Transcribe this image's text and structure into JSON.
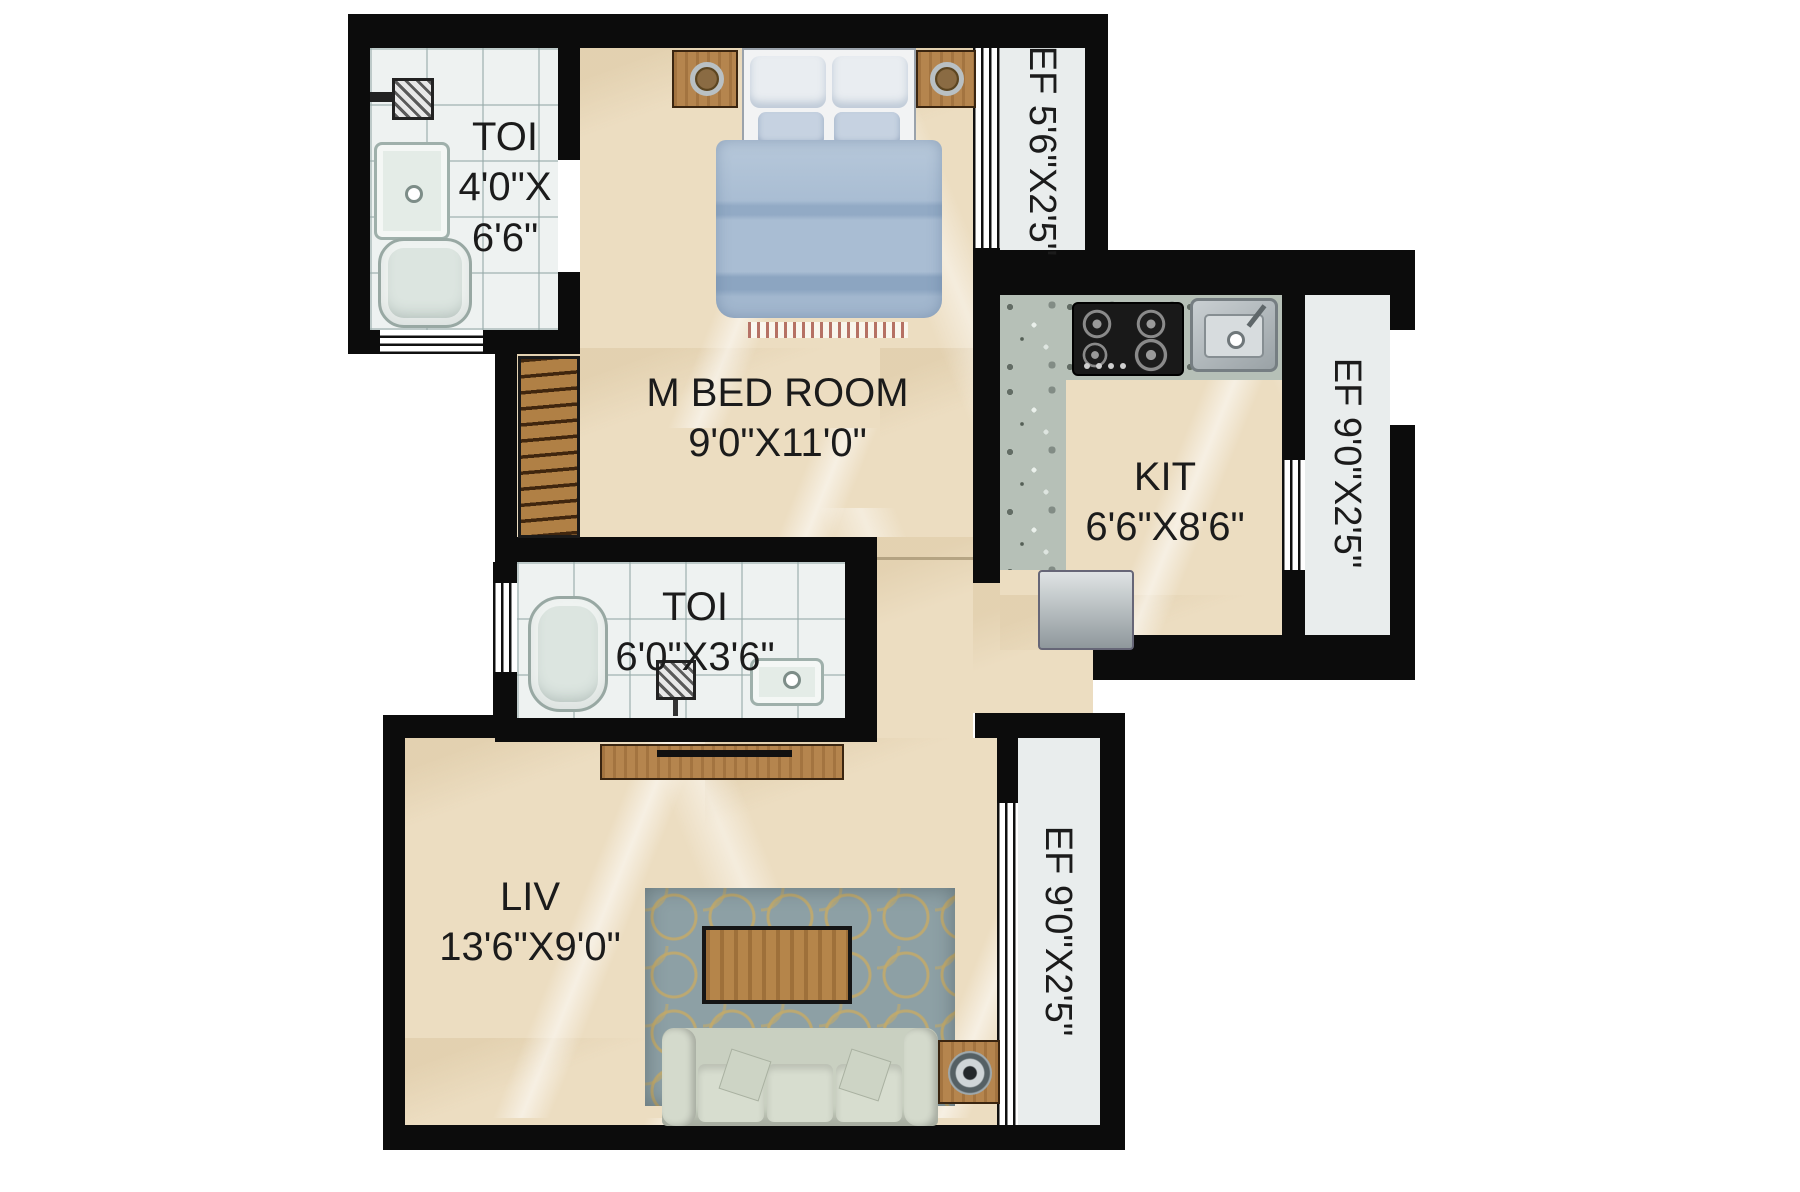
{
  "plan": {
    "type": "apartment-floor-plan",
    "rooms": {
      "toilet_top": {
        "name": "TOI",
        "dim_line1": "4'0\"X",
        "dim_line2": "6'6\""
      },
      "master_bedroom": {
        "name": "M BED ROOM",
        "dims": "9'0\"X11'0\""
      },
      "ef_top_right": {
        "label": "EF 5'6\"X2'5\""
      },
      "kitchen": {
        "name": "KIT",
        "dims": "6'6\"X8'6\""
      },
      "ef_kitchen_right": {
        "label": "EF 9'0\"X2'5\""
      },
      "toilet_middle": {
        "name": "TOI",
        "dims": "6'0\"X3'6\""
      },
      "living": {
        "name": "LIV",
        "dims": "13'6\"X9'0\""
      },
      "ef_living_right": {
        "label": "EF 9'0\"X2'5\""
      }
    },
    "palette": {
      "wall": "#0c0c0c",
      "marble_floor": "#ecddc1",
      "tile_floor": "#eef2f1",
      "granite_counter": "#b6c0b7",
      "ef_floor": "#e9eded",
      "wood": "#b5854e",
      "bed_blue": "#a9bdd3",
      "sofa_green": "#c9d0c1",
      "rug_blue": "#8da0a5",
      "rug_gold": "#c4aa68",
      "label_text": "#1b1b1b"
    },
    "furniture_icons": [
      "double-bed",
      "nightstand",
      "wardrobe",
      "wash-basin",
      "shower-mixer",
      "toilet-commode",
      "floor-drain",
      "gas-stove",
      "kitchen-sink",
      "refrigerator",
      "tv-cabinet",
      "area-rug",
      "coffee-table",
      "sofa",
      "speaker-table"
    ]
  }
}
